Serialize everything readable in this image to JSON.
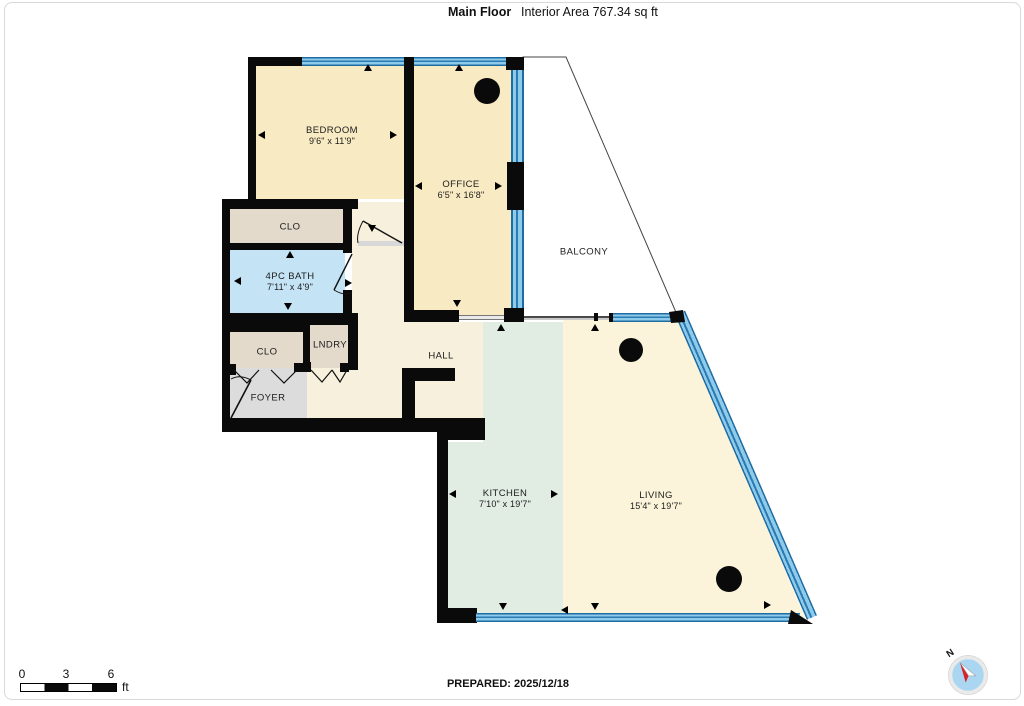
{
  "header": {
    "title": "Main Floor",
    "subtitle": "Interior Area 767.34 sq ft"
  },
  "rooms": [
    {
      "id": "bedroom",
      "name": "BEDROOM",
      "dims": "9'6\" x 11'9\""
    },
    {
      "id": "office",
      "name": "OFFICE",
      "dims": "6'5\" x 16'8\""
    },
    {
      "id": "balcony",
      "name": "BALCONY",
      "dims": ""
    },
    {
      "id": "closet-top",
      "name": "CLO",
      "dims": ""
    },
    {
      "id": "bath",
      "name": "4PC BATH",
      "dims": "7'11\" x 4'9\""
    },
    {
      "id": "closet-bottom",
      "name": "CLO",
      "dims": ""
    },
    {
      "id": "laundry",
      "name": "LNDRY",
      "dims": ""
    },
    {
      "id": "foyer",
      "name": "FOYER",
      "dims": ""
    },
    {
      "id": "hall",
      "name": "HALL",
      "dims": ""
    },
    {
      "id": "kitchen",
      "name": "KITCHEN",
      "dims": "7'10\" x 19'7\""
    },
    {
      "id": "living",
      "name": "LIVING",
      "dims": "15'4\" x 19'7\""
    }
  ],
  "scale_bar": {
    "ticks": [
      "0",
      "3",
      "6"
    ],
    "unit": "ft"
  },
  "footer": {
    "prepared": "PREPARED: 2025/12/18"
  },
  "compass": {
    "label": "N"
  },
  "colors": {
    "room_cream": "#F8EAC2",
    "hall_cream": "#F7F0DC",
    "living_cream": "#FBF4DA",
    "kitchen_mint": "#E1ECE3",
    "bath_blue": "#C4E4F6",
    "closet_tan": "#E4DACB",
    "foyer_gray": "#DCDCDC",
    "window_blue": "#8ECBEB",
    "window_line": "#1D6CA3",
    "wall_black": "#0A0A0A",
    "compass_red": "#D8222A",
    "compass_blue": "#ABD6F1"
  }
}
